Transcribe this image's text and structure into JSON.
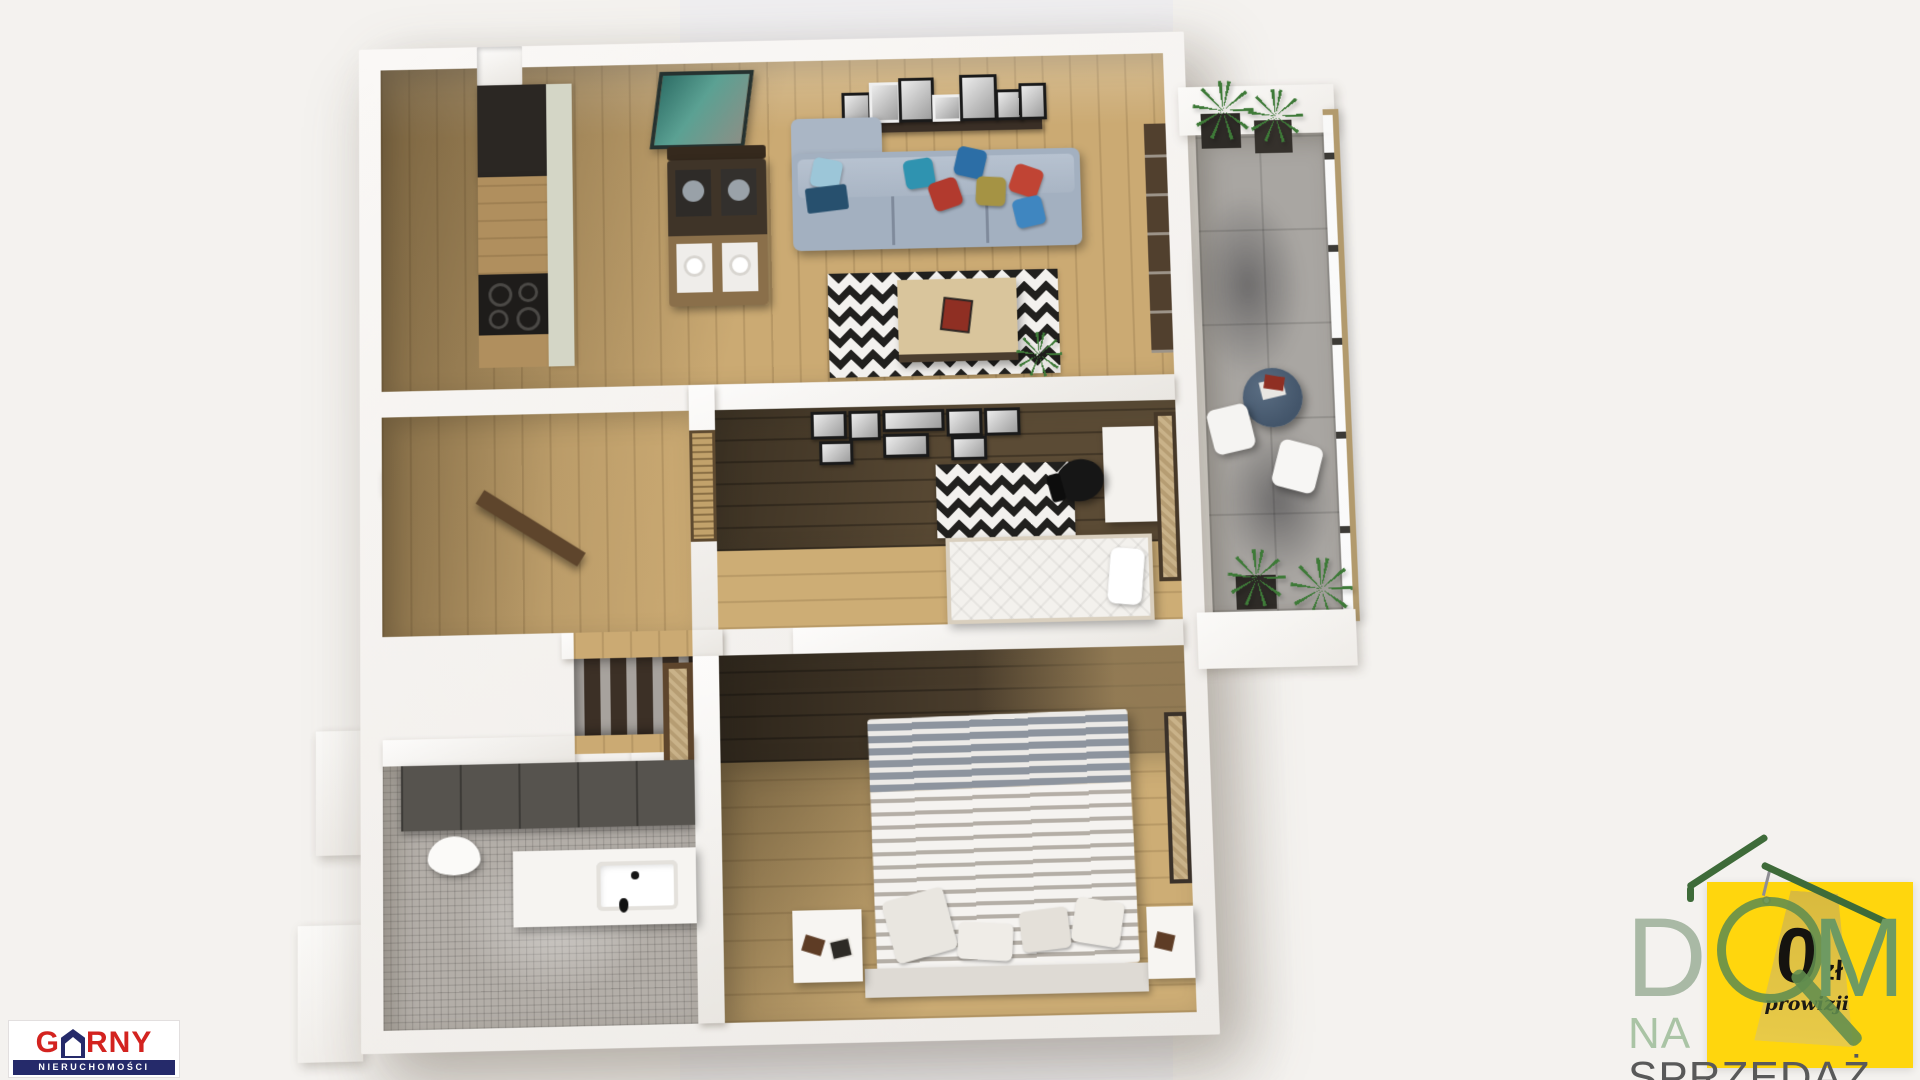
{
  "scene": {
    "description": "3D top-down dollhouse render of a furnished two-bedroom apartment with a balcony, presented on a pale background",
    "view": "bird's-eye 3D floor plan, slight perspective tilt",
    "rooms": [
      {
        "id": "living-room-with-kitchenette",
        "features": [
          "kitchen unit with dark tall cabinet, wooden counter and black 4-burner hob",
          "dark wood dining table with bench and four place settings",
          "teal abstract wall art",
          "picture ledge with seven black-and-white framed photos",
          "gray-blue corner sofa with colorful cushions (teal, blue, red, olive)",
          "black-and-white chevron rug",
          "light wood coffee table with books",
          "green potted plant",
          "dark-framed glass door to balcony"
        ]
      },
      {
        "id": "balcony",
        "features": [
          "gray tile floor",
          "glass railing with bronze frame",
          "four planters with tall grasses",
          "round dark glass table with magazines",
          "two white chairs",
          "plant shadows on tiles"
        ]
      },
      {
        "id": "office-bedroom",
        "features": [
          "gallery wall with eight black framed prints",
          "dark plank floor band and light wood floor",
          "black-and-white chevron rug",
          "white desk",
          "black office chair",
          "single bed with white mattress and pillow",
          "window with wooden blinds",
          "rattan window panel to balcony"
        ]
      },
      {
        "id": "main-bedroom",
        "features": [
          "dark wood accent floor band",
          "light plank floor",
          "double bed with gray-and-white striped bedding",
          "four light pillows",
          "bench platform at foot of bed",
          "two white cube nightstands with books",
          "dark-framed rattan window"
        ]
      },
      {
        "id": "bathroom",
        "features": [
          "dark gray tiled wall",
          "wall-hung white toilet",
          "white vanity with washbasin and black tap",
          "gray mosaic tile floor"
        ]
      },
      {
        "id": "hallway",
        "features": [
          "light wood corridor floor",
          "entry door ajar",
          "dark wardrobe panel with coat hooks",
          "rattan-insert interior door"
        ]
      }
    ],
    "palette": {
      "background": "#f4f2ef",
      "background_band": "#efeef0",
      "wall_white": "#faf8f6",
      "wall_shadow": "#d8d3cf",
      "floor_wood_light": "#cbaa73",
      "floor_wood_dark": "#5b4b35",
      "rug_black": "#21201e",
      "sofa_gray_blue": "#a3b0c0",
      "balcony_tile": "#a9a6a2",
      "bathroom_tile": "#56534e",
      "pillow_teal": "#2f93b0",
      "pillow_blue": "#2c6ea6",
      "pillow_red": "#b23a2e",
      "pillow_olive": "#a59344"
    }
  },
  "branding": {
    "agency": {
      "name_prefix": "G",
      "name_suffix": "RNY",
      "full_name": "GÓRNY",
      "subtitle": "NIERUCHOMOŚCI",
      "name_color": "#d3231f",
      "bar_color": "#252a6a"
    }
  },
  "watermark": {
    "word": "DOM",
    "letter_d": "D",
    "letter_m": "M",
    "line2_na": "NA",
    "line2_sprzedaz": "SPRZEDAŻ",
    "badge": {
      "amount": "0",
      "currency": "zł",
      "caption": "prowizji",
      "card_color": "#ffd60d",
      "tag_color": "#e0c243"
    },
    "green_dark": "#3e6b39",
    "green_ring": "#618d4f",
    "green_light": "#aac4a5",
    "gray_text": "#595959"
  }
}
